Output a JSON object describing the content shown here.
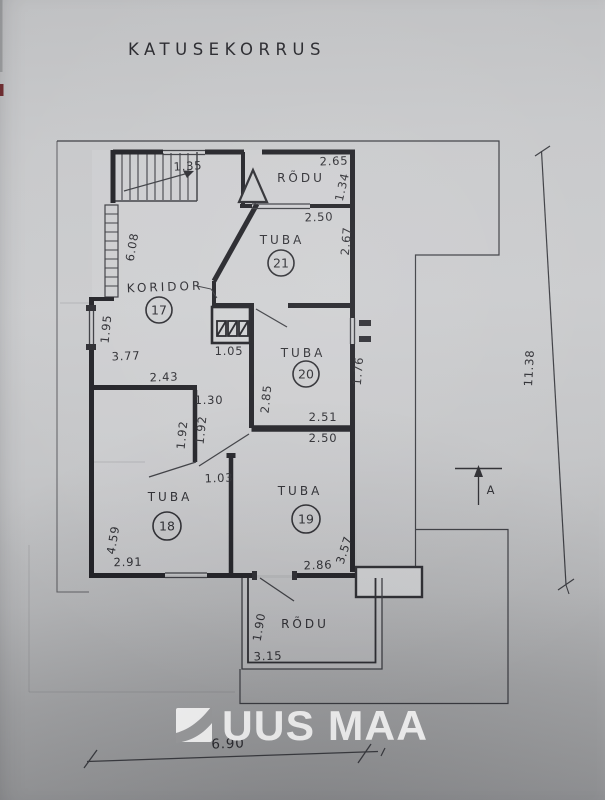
{
  "title": "KATUSEKORRUS",
  "rooms": {
    "koridor": {
      "label": "KORIDOR",
      "number": "17"
    },
    "tuba21": {
      "label": "TUBA",
      "number": "21"
    },
    "tuba20": {
      "label": "TUBA",
      "number": "20"
    },
    "tuba19": {
      "label": "TUBA",
      "number": "19"
    },
    "tuba18": {
      "label": "TUBA",
      "number": "18"
    },
    "rodu_top": {
      "label": "RÕDU"
    },
    "rodu_bottom": {
      "label": "RÕDU"
    }
  },
  "dims": {
    "d135": "1.35",
    "d265": "2.65",
    "d134": "1.34",
    "d250_top": "2.50",
    "d267": "2.67",
    "d608": "6.08",
    "d195": "1.95",
    "d377": "3.77",
    "d243": "2.43",
    "d105": "1.05",
    "d176": "1.76",
    "d130": "1.30",
    "d285": "2.85",
    "d251": "2.51",
    "d250_mid": "2.50",
    "d192_left": "1.92",
    "d192_right": "1.92",
    "d103": "1.03",
    "d459": "4.59",
    "d291": "2.91",
    "d286": "2.86",
    "d357": "3.57",
    "d190": "1.90",
    "d315": "3.15",
    "d1138": "11.38",
    "d690": "6.90"
  },
  "section_marker": "A",
  "logo": {
    "text": "UUS MAA"
  },
  "colors": {
    "paper": "#c5c6c8",
    "ink": "#2a2a2f",
    "wall": "#1f1f24",
    "logo": "#ffffff",
    "corner_mark": "#6b2a2e"
  }
}
